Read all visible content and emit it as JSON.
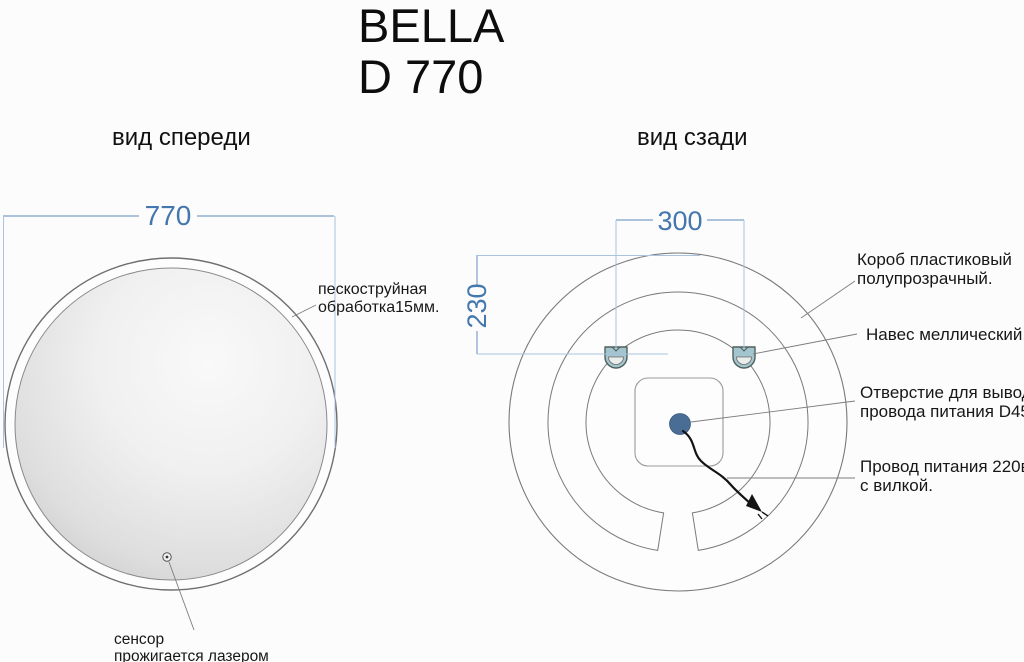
{
  "title": {
    "lines": [
      "BELLA",
      "D 770"
    ]
  },
  "front_view": {
    "label": "вид спереди",
    "dimensions": {
      "diameter": "770"
    },
    "notes": {
      "sandblast": [
        "пескоструйная",
        "обработка15мм."
      ],
      "sensor": [
        "сенсор",
        "прожигается лазером"
      ]
    }
  },
  "back_view": {
    "label": "вид сзади",
    "dimensions": {
      "hanger_spacing": "300",
      "hanger_top_offset": "230"
    },
    "notes": {
      "box": [
        "Короб пластиковый",
        "полупрозрачный."
      ],
      "hanger": [
        "Навес меллический."
      ],
      "cord_hole": [
        "Отверстие для вывода",
        "провода питания D45"
      ],
      "power_cord": [
        "Провод питания 220в.",
        "с вилкой."
      ]
    }
  },
  "colors": {
    "dimension_text": "#4477ad",
    "dimension_line": "#7da0c8",
    "extension_line": "#a9c2dd",
    "cord_hole_fill": "#4a6d96",
    "hanger_fill": "#a3c5cd",
    "drawing_line": "#7a7a7a"
  }
}
